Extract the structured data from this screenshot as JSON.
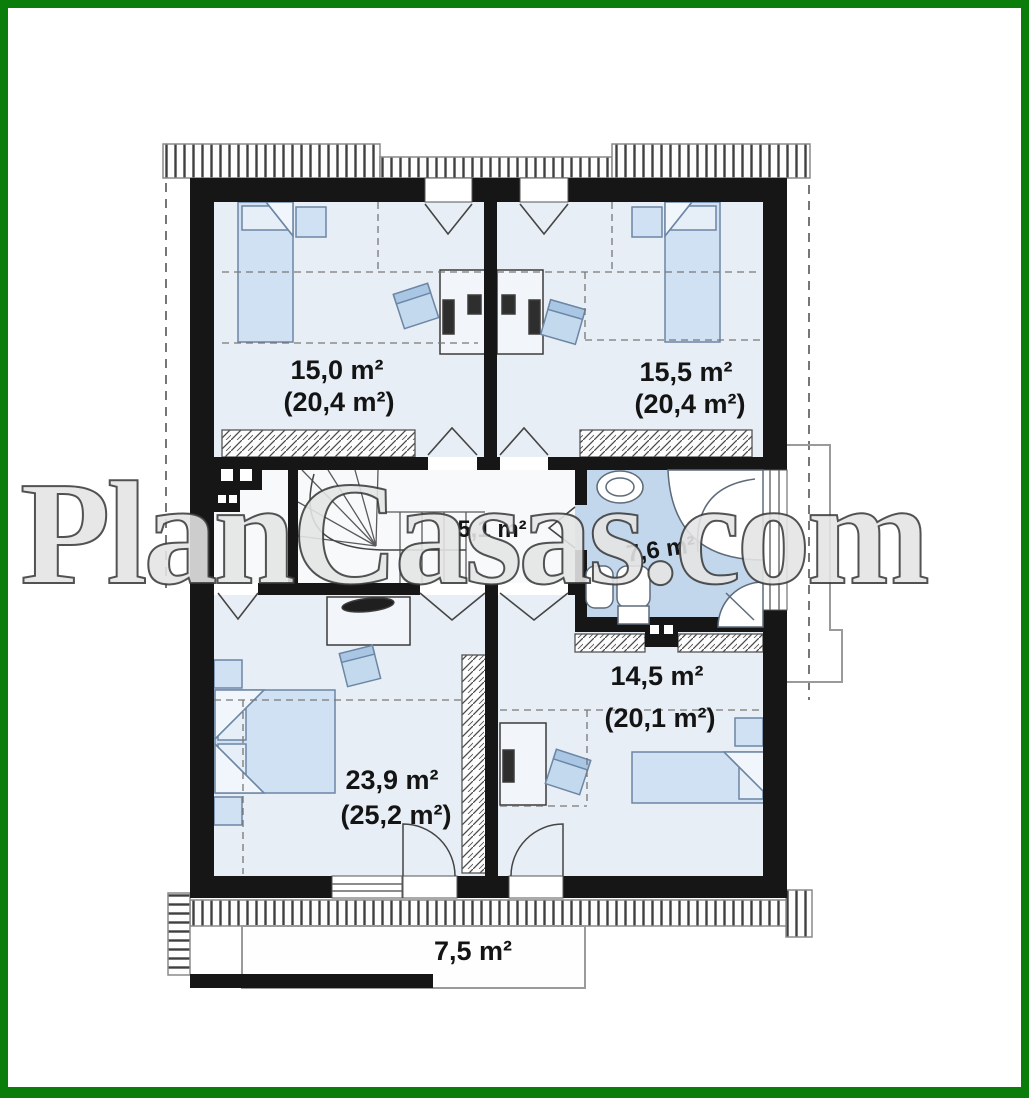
{
  "watermark": "PlanCasas.com",
  "plan": {
    "rooms": [
      {
        "name": "bedroom-top-left",
        "area": "15,0 m²",
        "total": "(20,4 m²)"
      },
      {
        "name": "bedroom-top-right",
        "area": "15,5 m²",
        "total": "(20,4 m²)"
      },
      {
        "name": "hall-stairs",
        "area": "5,1 m²",
        "total": ""
      },
      {
        "name": "bathroom",
        "area": "7,6 m²",
        "total": ""
      },
      {
        "name": "bedroom-bottom-right",
        "area": "14,5 m²",
        "total": "(20,1 m²)"
      },
      {
        "name": "bedroom-bottom-left",
        "area": "23,9 m²",
        "total": "(25,2 m²)"
      },
      {
        "name": "balcony",
        "area": "7,5 m²",
        "total": ""
      }
    ],
    "colors": {
      "frame_green": "#0a7d0a",
      "wall": "#161616",
      "bedroom_floor": "#e8eef5",
      "hall_floor": "#f7f9fb",
      "bathroom_floor": "#c2d6ec",
      "furniture_fill": "#cfe1f3",
      "furniture_stroke": "#6c86a4",
      "label_text": "#141414"
    }
  }
}
